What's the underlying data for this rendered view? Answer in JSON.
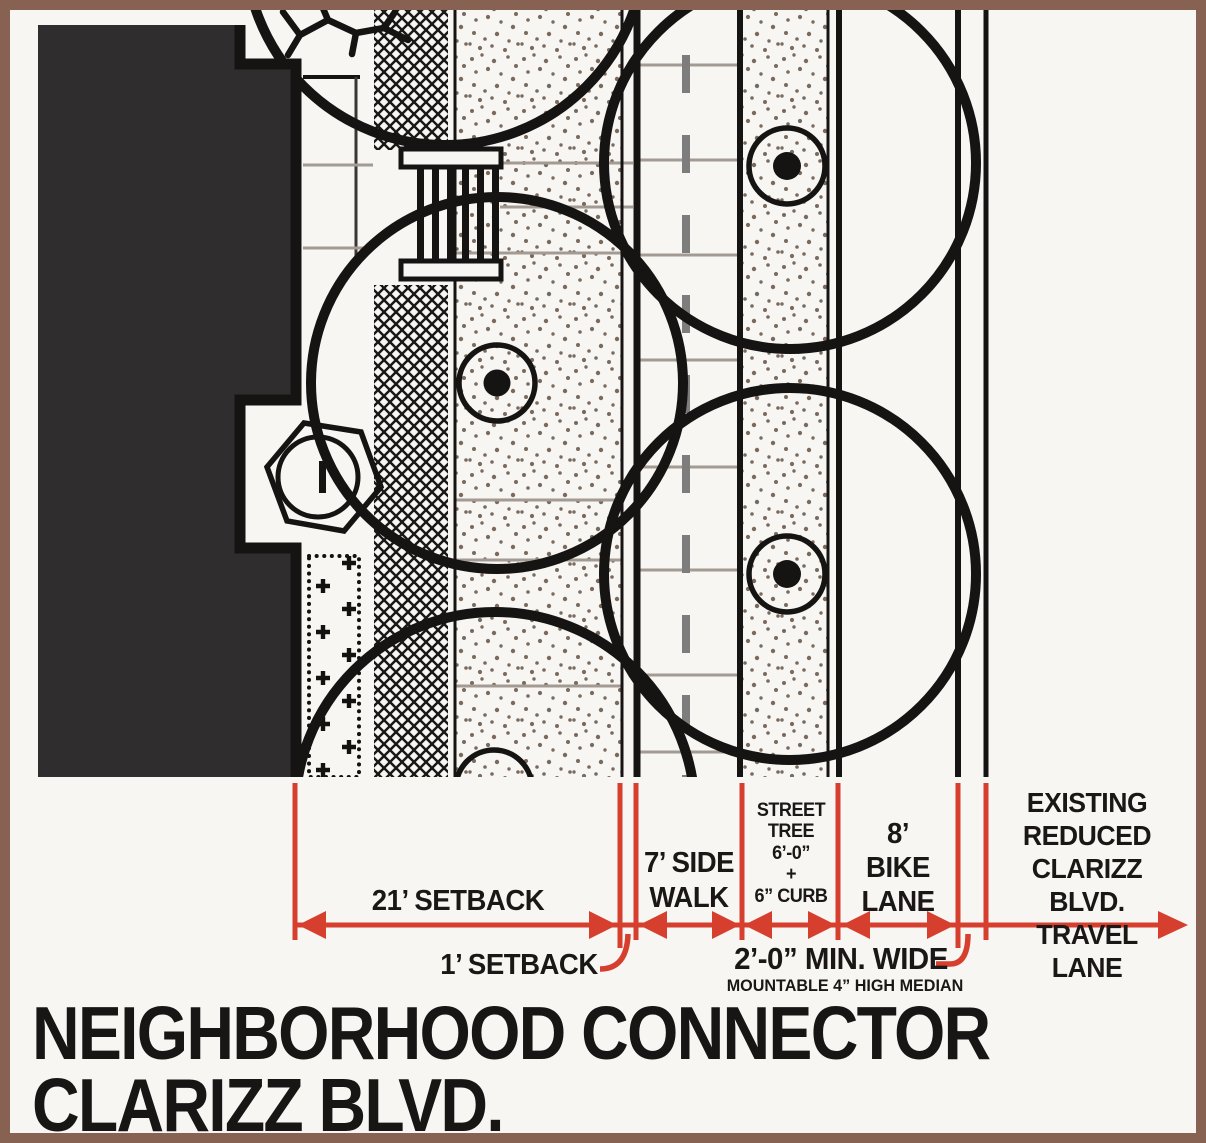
{
  "title": {
    "line1": "NEIGHBORHOOD CONNECTOR",
    "line2": "CLARIZZ BLVD."
  },
  "dimensions": {
    "setback21": "21’ SETBACK",
    "setback1": "1’ SETBACK",
    "sidewalk": "7’ SIDE\nWALK",
    "street_tree": "STREET\nTREE\n6’-0”\n+\n6” CURB",
    "bike_lane": "8’\nBIKE\nLANE",
    "median": "2’-0” MIN. WIDE",
    "median_sub": "MOUNTABLE 4” HIGH MEDIAN",
    "travel_lane": "EXISTING\nREDUCED\nCLARIZZ BLVD.\nTRAVEL LANE"
  },
  "colors": {
    "dimension_red": "#d63f2d",
    "frame_brown": "#876252",
    "building_dark": "#2f2d2d",
    "line_black": "#161313",
    "paper": "#f8f6f3",
    "stipple": "#7a6a5d"
  }
}
